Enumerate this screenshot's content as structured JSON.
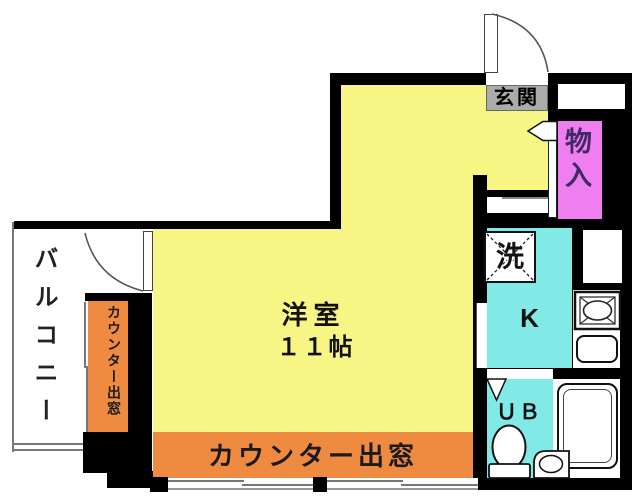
{
  "plan": {
    "rooms": {
      "living": {
        "name_label": "洋室",
        "size_label": "１１帖"
      },
      "entrance": {
        "label": "玄関"
      },
      "storage": {
        "label": "物入"
      },
      "laundry": {
        "label": "洗"
      },
      "kitchen": {
        "label": "K"
      },
      "unit_bath": {
        "label": "ＵＢ"
      },
      "balcony": {
        "label": "バルコニー"
      },
      "counter_window_south": {
        "label": "カウンター出窓"
      },
      "counter_window_west": {
        "label": "カウンター出窓"
      }
    },
    "colors": {
      "room_yellow": "#F7F583",
      "counter_orange": "#EF8A41",
      "wet_cyan": "#81E9E6",
      "closet_magenta": "#EF7EF0",
      "entrance_gray": "#ABABAB",
      "wall_black": "#000000"
    }
  }
}
